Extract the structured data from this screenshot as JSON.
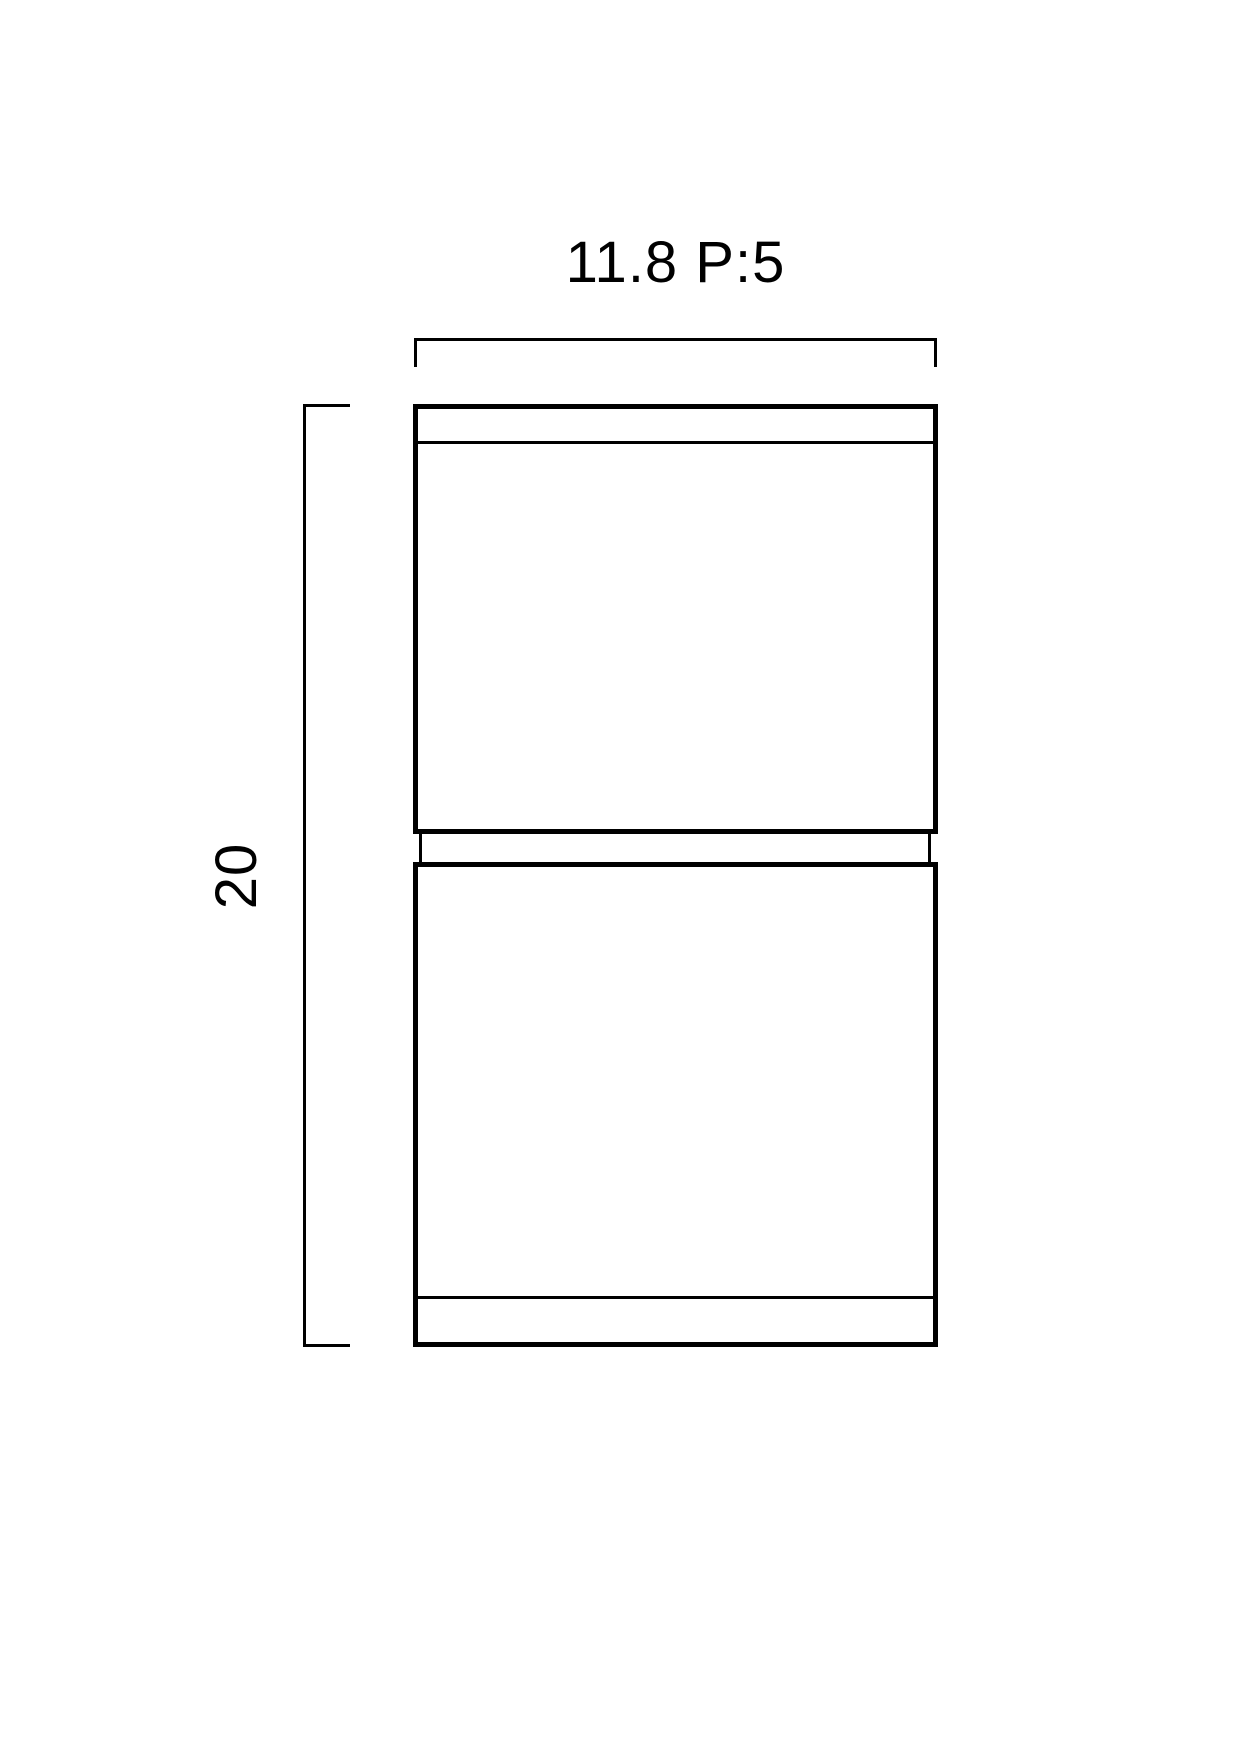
{
  "colors": {
    "background": "#ffffff",
    "line": "#000000"
  },
  "dimensions": {
    "width": {
      "label": "11.8 P:5",
      "value": 11.8,
      "suffix": "P:5"
    },
    "height": {
      "label": "20",
      "value": 20
    }
  }
}
